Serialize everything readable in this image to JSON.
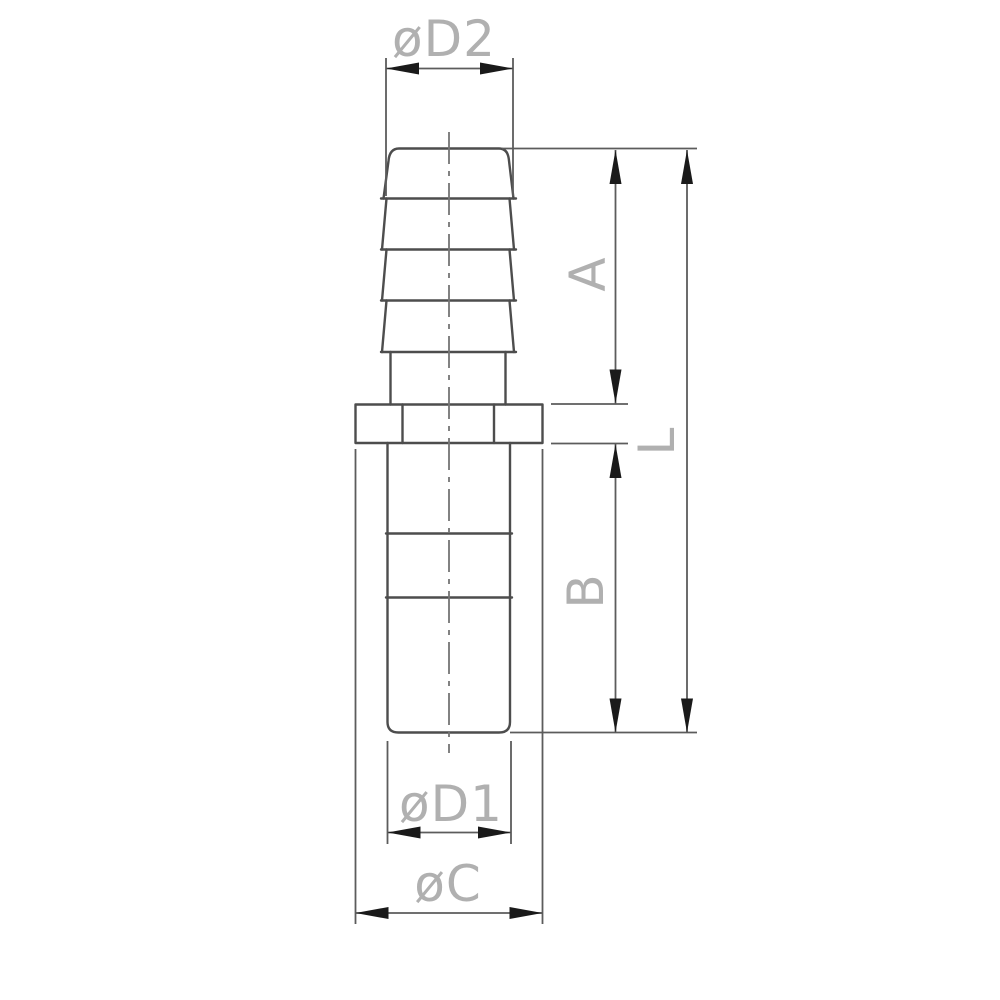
{
  "figure": {
    "labels": {
      "d2": "øD2",
      "a": "A",
      "l": "L",
      "b": "B",
      "d1": "øD1",
      "c": "øC"
    },
    "colors": {
      "background": "#ffffff",
      "part_outline": "#4d4d4d",
      "dimension_line": "#5c5c5c",
      "arrow": "#1a1a1a",
      "label_text": "#b0b0b0",
      "center_line": "#757575"
    }
  }
}
